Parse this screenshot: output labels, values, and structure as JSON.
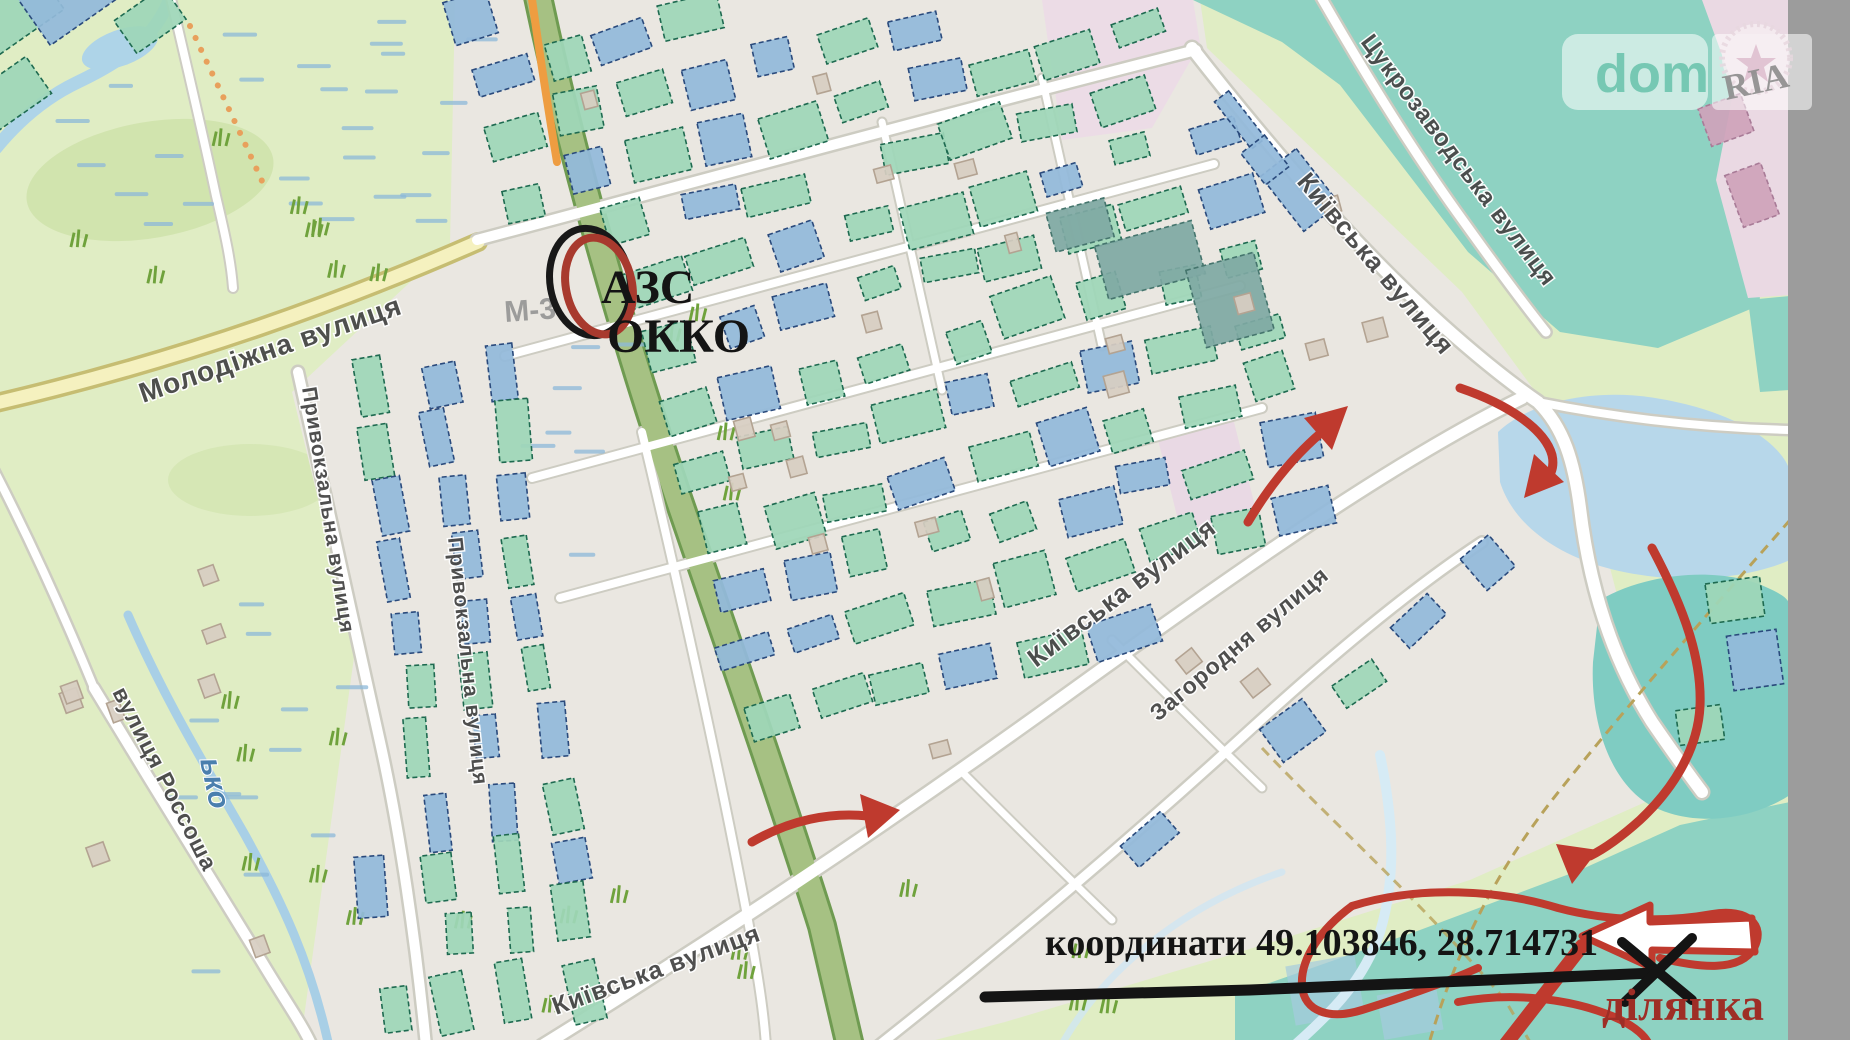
{
  "brand": {
    "left": "dom",
    "right": "RIA"
  },
  "map_annotations": {
    "poi": {
      "line1": "АЗС",
      "line2": "ОККО"
    },
    "coordinates": "координати 49.103846, 28.714731",
    "plot": "ділянка",
    "road_ref": "М-3"
  },
  "streets": [
    {
      "name": "Молодіжна вулиця"
    },
    {
      "name": "Привокзальна вулиця"
    },
    {
      "name": "Привокзальна вулиця"
    },
    {
      "name": "Київська вулиця"
    },
    {
      "name": "Київська вулиця"
    },
    {
      "name": "Київська вулиця"
    },
    {
      "name": "Загородня вулиця"
    },
    {
      "name": "Цукрозаводська вулиця"
    },
    {
      "name": "вулиця Россоша"
    }
  ],
  "water_label": {
    "text": "ько"
  },
  "colors": {
    "annotation_red": "#bf3a2e",
    "annotation_black": "#141414",
    "plot_text": "#9e2e26",
    "brand_teal": "#76c8b3",
    "building_teal": "#9ed6b8",
    "building_blue": "#92b9da",
    "pond_blue": "#b7d7ea",
    "teal_area": "#8ed2c2",
    "trunk_road_green": "#a6c183",
    "secondary_road_yellow": "#f5f1bf"
  }
}
